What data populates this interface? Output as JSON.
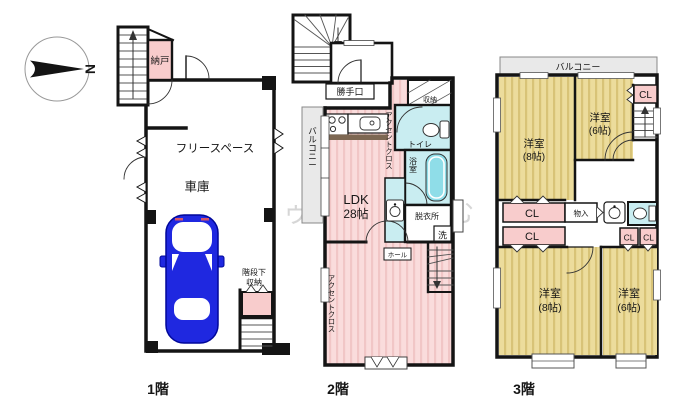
{
  "compass": {
    "north_label": "N"
  },
  "watermark": "ドゥまいほーむ",
  "colors": {
    "wall": "#141414",
    "room_pink": "#fadcdc",
    "closet_pink": "#f8cccc",
    "room_yellow": "#ecdc9c",
    "wet_cyan": "#c9edf1",
    "tub_cyan": "#8fdde8",
    "balcony_gray": "#e9e9e9",
    "car_blue": "#1f28e0"
  },
  "floor1": {
    "floor_label": "1階",
    "nando": "納戸",
    "free_space": "フリースペース",
    "garage": "車庫",
    "under_stairs_line1": "階段下",
    "under_stairs_line2": "収納"
  },
  "floor2": {
    "floor_label": "2階",
    "back_door": "勝手口",
    "balcony": "バルコニー",
    "storage": "収納",
    "toilet": "トイレ",
    "bath": "浴室",
    "dressing_room": "脱衣所",
    "laundry": "洗",
    "hall": "ホール",
    "ldk_name": "LDK",
    "ldk_size": "28帖",
    "accent_wall": "アクセントクロス"
  },
  "floor3": {
    "floor_label": "3階",
    "balcony": "バルコニー",
    "closet": "CL",
    "storage": "物入",
    "western_room": "洋室",
    "size_8": "(8帖)",
    "size_6": "(6帖)"
  }
}
